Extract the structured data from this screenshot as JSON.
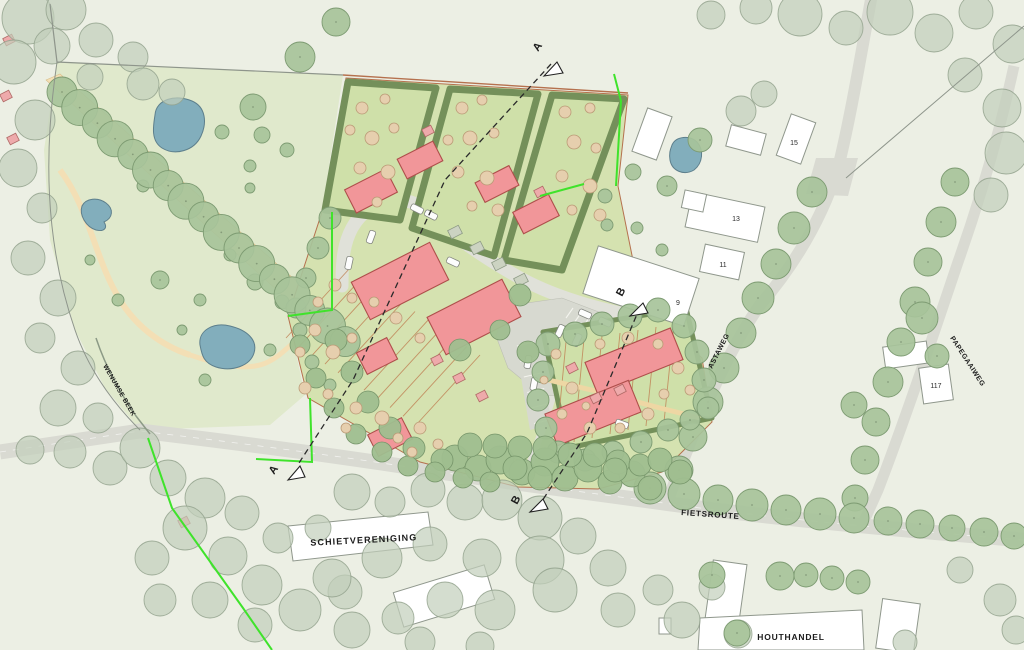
{
  "map": {
    "kind": "landscape site plan",
    "road_labels": {
      "fietsroute": "FIETSROUTE",
      "astaweg": "ASTAWEG",
      "papegaaiweg": "PAPEGAAIWEG",
      "wenumse_beek": "WENUMSE BEEK"
    },
    "site_labels": {
      "schietvereniging": "SCHIETVERENIGING",
      "houthandel": "HOUTHANDEL"
    },
    "house_numbers": [
      {
        "text": "15"
      },
      {
        "text": "13"
      },
      {
        "text": "11"
      },
      {
        "text": "9"
      },
      {
        "text": "117"
      }
    ],
    "section_markers": {
      "a": "A",
      "b": "B"
    },
    "colors": {
      "background": "#ecefe4",
      "meadow": "#e0e9cc",
      "parcel_green": "#d5e2b0",
      "hedge_fill": "#cfe0a9",
      "hedge_green": "#74905a",
      "tree_sage": "#a7c39a",
      "tree_pale": "#c2cfba",
      "pond_blue": "#82aebc",
      "path_tan": "#f3dfb5",
      "road_gray": "#d9dad2",
      "street_gray": "#e0e1d9",
      "building_red": "#f19699",
      "building_white": "#ffffff",
      "boundary_lime": "#3fe32b",
      "plan_boundary_red": "#b5714e",
      "section_line": "#2a2a2a"
    }
  }
}
